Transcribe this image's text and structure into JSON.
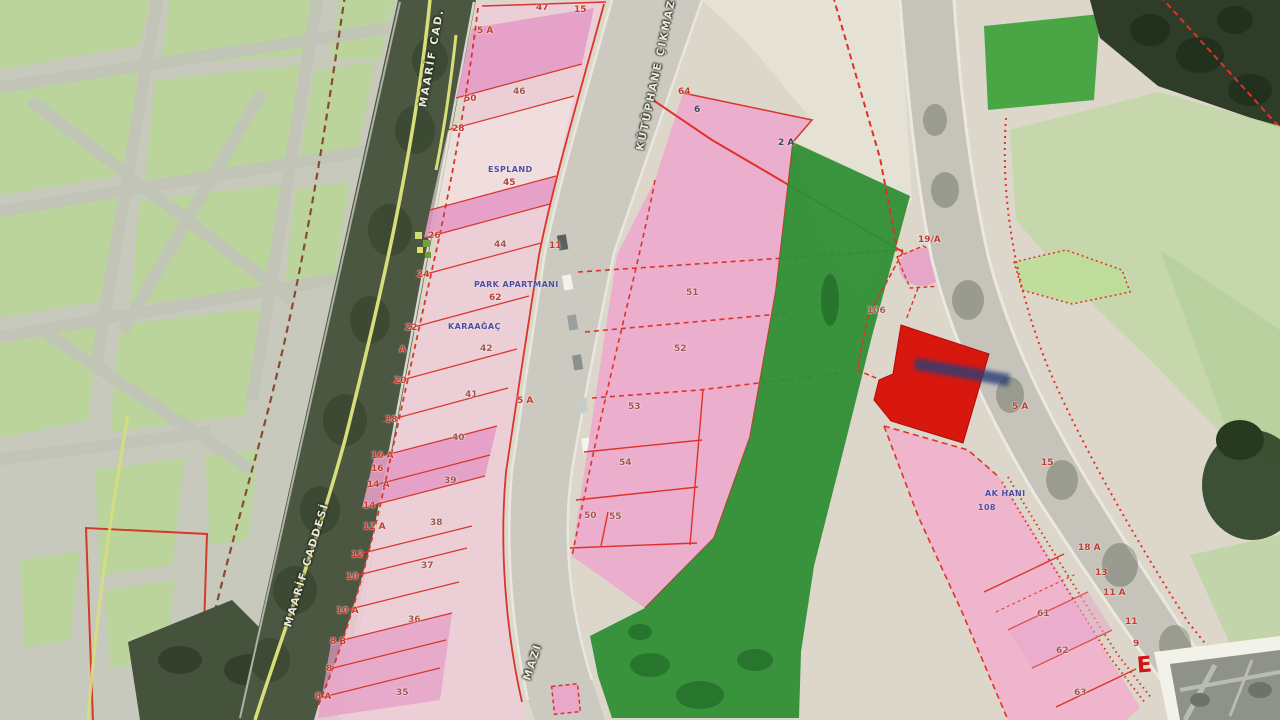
{
  "colors": {
    "parcel_pink": "#ecabcd",
    "bright_pink": "#e59cc6",
    "pale_pink": "#eccdd6",
    "zone_green": "#2e8e33",
    "field_green": "#3da23a",
    "park_green": "#b9d795",
    "line_red": "#e03128",
    "building_red": "#d8170f",
    "road_grey": "#ccc9c0"
  },
  "roads": {
    "maarif_top": "MAARİF CAD.",
    "maarif_mid": "MAARİF CADDESİ",
    "kutuphane_top": "KÜTÜPHANE ÇIKMAZI",
    "kutuphane_bottom": "MAZI"
  },
  "buildings": {
    "espland": {
      "name": "ESPLAND",
      "no": "45"
    },
    "park_apartmani": {
      "name": "PARK APARTMANI",
      "no": "62"
    },
    "karaagac": {
      "name": "KARAAĞAÇ",
      "no": "42"
    },
    "ak_hani": {
      "name": "AK HANI",
      "no": "108"
    }
  },
  "left_edge_numbers": [
    "47",
    "15",
    "5 A",
    "50",
    "28",
    "26",
    "24",
    "22",
    "A",
    "20",
    "18",
    "16 A",
    "16",
    "14 A",
    "14",
    "12 A",
    "12",
    "10",
    "10 A",
    "8 B",
    "8",
    "8 A"
  ],
  "left_parcel_numbers": [
    "46",
    "44",
    "11",
    "41",
    "5 A",
    "40",
    "39",
    "38",
    "37",
    "36",
    "35"
  ],
  "center_numbers": [
    "64",
    "6",
    "2 A",
    "51",
    "52",
    "53",
    "54",
    "50",
    "55",
    "106"
  ],
  "right_numbers": [
    "19/A",
    "5 A",
    "15",
    "18 A",
    "13",
    "11 A",
    "11",
    "9",
    "61",
    "62",
    "63"
  ],
  "legend": {
    "e": "E"
  }
}
